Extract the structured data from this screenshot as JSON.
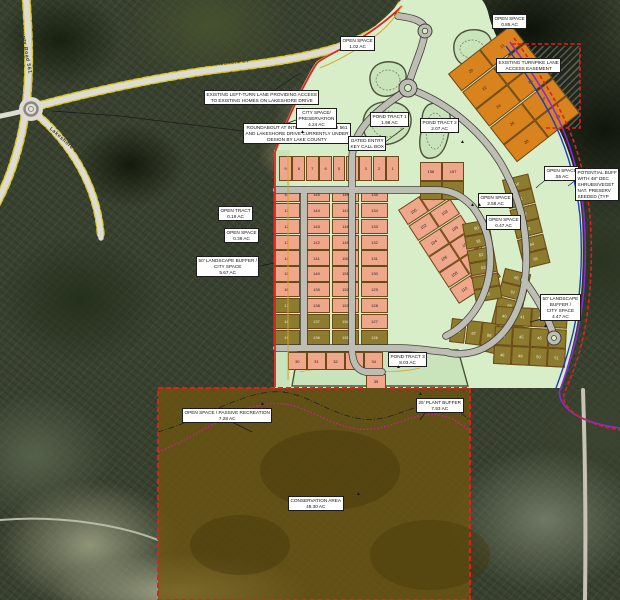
{
  "map": {
    "road_labels": {
      "cr561": "County Road 561",
      "lakeshore_top": "Lakeshore Dr",
      "lakeshore_sw": "Lakeshore Dr"
    },
    "notes": {
      "roundabout_note": {
        "lines": [
          "ROUNDABOUT AT INTERSECTION OF CR 561",
          "AND LAKESHORE DRIVE CURRENTLY UNDER",
          "DESIGN BY LAKE COUNTY"
        ]
      },
      "left_turn_note": {
        "lines": [
          "EXISTING LEFT-TURN LANE PROVIDING ACCESS",
          "TO EXISTING HOMES ON LAKESHORE DRIVE"
        ]
      },
      "os_nw": {
        "lines": [
          "OPEN SPACE",
          "1.02 AC"
        ]
      },
      "os_ne": {
        "lines": [
          "OPEN SPACE",
          "0.85 AC"
        ]
      },
      "turnpike_note": {
        "lines": [
          "EXISTING TURNPIKE LANE",
          "ACCESS EASEMENT"
        ]
      },
      "city_space": {
        "lines": [
          "CITY SPACE/",
          "PRESERVATION",
          "4.24 AC"
        ]
      },
      "pond1": {
        "lines": [
          "POND TRACT 1",
          "1.98 AC"
        ]
      },
      "pond2": {
        "lines": [
          "POND TRACT 2",
          "2.07 AC"
        ]
      },
      "pond3": {
        "lines": [
          "POND TRACT 3",
          "8.03 AC"
        ]
      },
      "gated_entry": {
        "lines": [
          "GATED ENTRY",
          "KEY CALL BOX"
        ]
      },
      "open_tract": {
        "lines": [
          "OPEN TRACT",
          "0.19 AC"
        ]
      },
      "os_left": {
        "lines": [
          "OPEN SPACE",
          "0.39 AC"
        ]
      },
      "buffer_left": {
        "lines": [
          "50' LANDSCAPE BUFFER /",
          "CITY SPACE",
          "5.67 AC"
        ]
      },
      "os_c1": {
        "lines": [
          "OPEN SPACE",
          "2.58 AC"
        ]
      },
      "os_c2": {
        "lines": [
          "OPEN SPACE",
          "0.47 AC"
        ]
      },
      "os_sr": {
        "lines": [
          "OPEN SPACE",
          ".55 AC"
        ]
      },
      "potential_note": {
        "lines": [
          "POTENTIAL BUFF",
          "WITH 48\" DEC",
          "SHRUBS/VEGET",
          "NAT. PRESERV",
          "SEEDED (TYP"
        ]
      },
      "buffer_right": {
        "lines": [
          "50' LANDSCAPE",
          "BUFFER /",
          "CITY SPACE",
          "4.47 AC"
        ]
      },
      "os_passive": {
        "lines": [
          "OPEN SPACE / PASSIVE RECREATION",
          "7.28 AC"
        ]
      },
      "plant_buffer": {
        "lines": [
          "25' PLANT BUFFER",
          "7.53 AC"
        ]
      },
      "conservation": {
        "lines": [
          "CONSERVATION AREA",
          "48.30 AC"
        ]
      }
    },
    "markers": {
      "tree": "▲"
    },
    "colors": {
      "plan_green": "#d8eec8",
      "lot_salmon": "#efa78b",
      "lot_olive": "#8d7b30",
      "lot_orange": "#d9831f",
      "conservation_brown": "#6e5610",
      "boundary_red": "#e02020",
      "utility_purple": "#8a2bd6",
      "utility_blue": "#2238c8",
      "road_edge_yellow": "#d8c92c",
      "wetland_magenta": "#d02090"
    },
    "lot_blocks": [
      {
        "kind": "k-s",
        "cells": [
          {
            "n": "9"
          },
          {
            "n": "8"
          },
          {
            "n": "7"
          },
          {
            "n": "6"
          },
          {
            "n": "5"
          },
          {
            "n": "4"
          },
          {
            "n": "3"
          },
          {
            "n": "2"
          },
          {
            "n": "1"
          }
        ]
      },
      {
        "kind": "k-s",
        "cells": [
          {
            "n": "10"
          },
          {
            "n": "11"
          },
          {
            "n": "12"
          },
          {
            "n": "13"
          },
          {
            "n": "14"
          },
          {
            "n": "15"
          },
          {
            "n": "16"
          },
          {
            "n": "17",
            "k": "k-o"
          },
          {
            "n": "18",
            "k": "k-o"
          },
          {
            "n": "19",
            "k": "k-o"
          }
        ]
      },
      {
        "kind": "k-s",
        "cells": [
          {
            "n": "145"
          },
          {
            "n": "144"
          },
          {
            "n": "143"
          },
          {
            "n": "142"
          },
          {
            "n": "141"
          },
          {
            "n": "140"
          },
          {
            "n": "139"
          },
          {
            "n": "138"
          },
          {
            "n": "137",
            "k": "k-o"
          },
          {
            "n": "136",
            "k": "k-o"
          }
        ]
      },
      {
        "kind": "k-s",
        "cells": [
          {
            "n": "146"
          },
          {
            "n": "147"
          },
          {
            "n": "148"
          },
          {
            "n": "149"
          },
          {
            "n": "150"
          },
          {
            "n": "151"
          },
          {
            "n": "152"
          },
          {
            "n": "153"
          },
          {
            "n": "154",
            "k": "k-o"
          },
          {
            "n": "155",
            "k": "k-o"
          }
        ]
      },
      {
        "kind": "k-s",
        "cells": [
          {
            "n": "135"
          },
          {
            "n": "134"
          },
          {
            "n": "133"
          },
          {
            "n": "132"
          },
          {
            "n": "131"
          },
          {
            "n": "130"
          },
          {
            "n": "129"
          },
          {
            "n": "128"
          },
          {
            "n": "127"
          },
          {
            "n": "126",
            "k": "k-o"
          }
        ]
      },
      {
        "kind": "k-s",
        "cells": [
          {
            "n": "100"
          },
          {
            "n": "101"
          },
          {
            "n": "102"
          },
          {
            "n": "103"
          },
          {
            "n": "104"
          },
          {
            "n": "105"
          },
          {
            "n": "106"
          },
          {
            "n": "107"
          },
          {
            "n": "108"
          },
          {
            "n": "109"
          },
          {
            "n": "110"
          },
          {
            "n": "111"
          }
        ]
      },
      {
        "kind": "k-g",
        "cells": [
          {
            "n": "20"
          },
          {
            "n": "21"
          },
          {
            "n": "22"
          },
          {
            "n": "23"
          },
          {
            "n": "24"
          },
          {
            "n": "25"
          },
          {
            "n": "26"
          },
          {
            "n": "27"
          },
          {
            "n": "28"
          },
          {
            "n": "29"
          }
        ]
      },
      {
        "kind": "k-o",
        "cells": [
          {
            "n": "60"
          },
          {
            "n": "61"
          },
          {
            "n": "62"
          },
          {
            "n": "63"
          },
          {
            "n": "64"
          },
          {
            "n": "65"
          }
        ]
      },
      {
        "kind": "k-o",
        "cells": [
          {
            "n": "66"
          },
          {
            "n": "67"
          },
          {
            "n": "68"
          },
          {
            "n": "69"
          },
          {
            "n": "70"
          },
          {
            "n": "71"
          }
        ]
      },
      {
        "kind": "k-o",
        "cells": [
          {
            "n": "80"
          },
          {
            "n": "81"
          },
          {
            "n": "82"
          },
          {
            "n": "83"
          },
          {
            "n": "84"
          },
          {
            "n": "85"
          }
        ]
      },
      {
        "kind": "k-o",
        "cells": [
          {
            "n": "86"
          },
          {
            "n": "87"
          },
          {
            "n": "88"
          },
          {
            "n": "89"
          },
          {
            "n": "90"
          }
        ]
      },
      {
        "kind": "k-o",
        "cells": [
          {
            "n": "40"
          },
          {
            "n": "41"
          },
          {
            "n": "42"
          },
          {
            "n": "43"
          },
          {
            "n": "44"
          },
          {
            "n": "45"
          },
          {
            "n": "46"
          },
          {
            "n": "47"
          },
          {
            "n": "48"
          },
          {
            "n": "49"
          },
          {
            "n": "50"
          },
          {
            "n": "51"
          }
        ]
      },
      {
        "kind": "k-s",
        "cells": [
          {
            "n": "30"
          },
          {
            "n": "31"
          },
          {
            "n": "32"
          },
          {
            "n": "33"
          },
          {
            "n": "34"
          }
        ]
      },
      {
        "kind": "k-s",
        "cells": [
          {
            "n": "35"
          }
        ]
      },
      {
        "kind": "k-s",
        "cells": [
          {
            "n": "156"
          },
          {
            "n": "157"
          },
          {
            "n": "158",
            "k": "k-o"
          },
          {
            "n": "159",
            "k": "k-o"
          }
        ]
      }
    ]
  }
}
